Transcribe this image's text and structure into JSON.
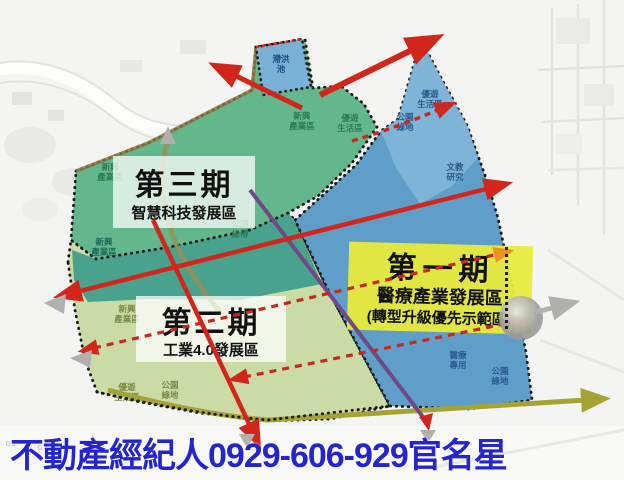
{
  "banner": {
    "text": "不動產經紀人0929-606-929官名星"
  },
  "phases": {
    "phase1": {
      "title": "第一期",
      "line2": "醫療產業發展區",
      "line3": "(轉型升級優先示範區)"
    },
    "phase2": {
      "title": "第二期",
      "line2": "工業4.0發展區"
    },
    "phase3": {
      "title": "第三期",
      "line2": "智慧科技發展區"
    }
  },
  "zone_labels": {
    "new_industry": {
      "l1": "新興",
      "l2": "產業區"
    },
    "park_belt": {
      "l1": "公園",
      "l2": "綠帶"
    },
    "leisure": {
      "l1": "優遊",
      "l2": "生活區"
    },
    "park_green": {
      "l1": "公園",
      "l2": "綠地"
    },
    "culture": {
      "l1": "文教",
      "l2": "研究"
    },
    "medical": {
      "l1": "醫療",
      "l2": "專用"
    },
    "pond": {
      "l1": "滯洪",
      "l2": "池"
    }
  },
  "scale": {
    "t1": "0.2",
    "t2": "0.4"
  },
  "colors": {
    "phase3_green": "#63b78d",
    "teal_zone": "#48a28d",
    "phase2_green": "#cbdba6",
    "phase1_blue": "#5f9ec9",
    "phase1_blue_light": "#84b7d9",
    "pond_blue": "#79b0d6",
    "highlight_yellow": "#e8ea3c",
    "arrow_red": "#d2251c",
    "arrow_orange": "#f09020",
    "arrow_olive": "#a4a434",
    "line_purple": "#6f4a85",
    "road_khaki": "#9b8d58",
    "banner_blue": "#2424d0"
  }
}
